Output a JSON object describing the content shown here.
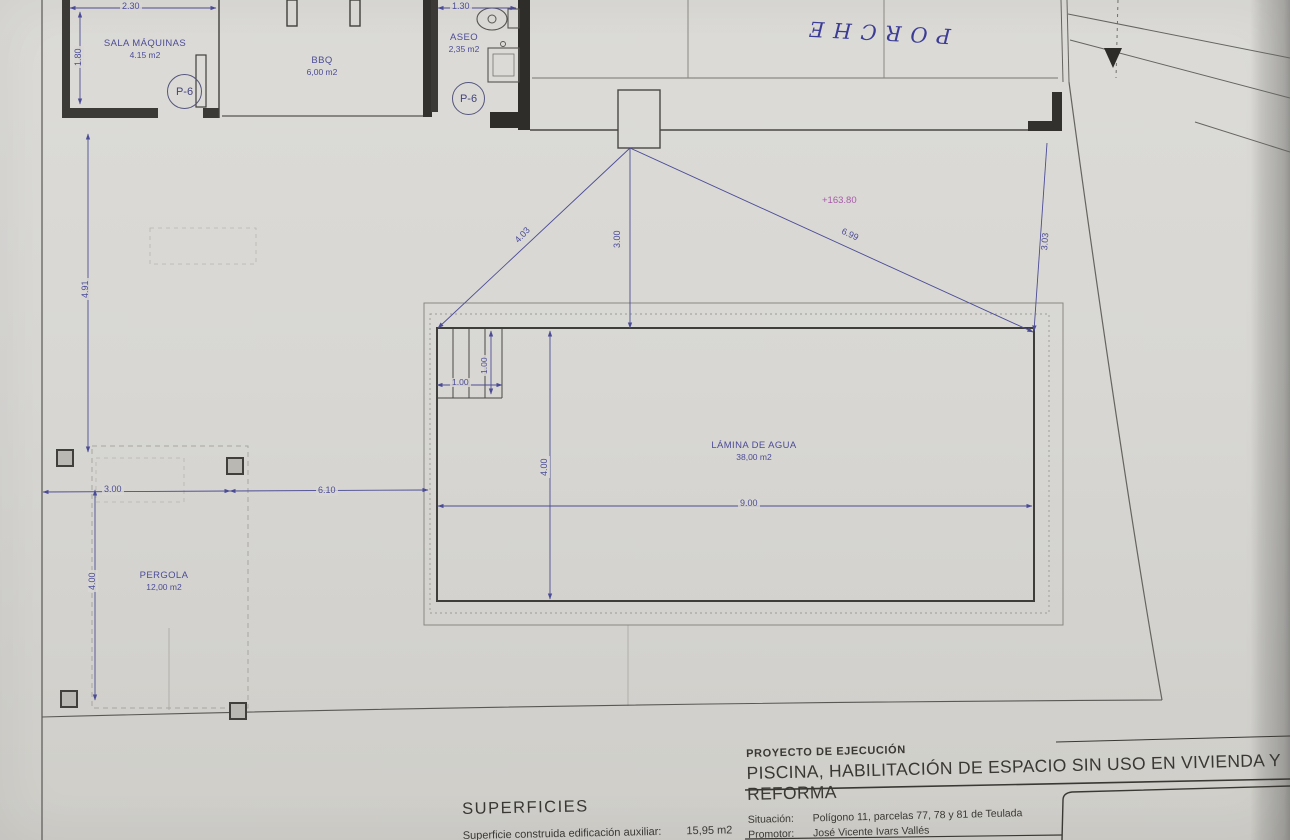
{
  "plan": {
    "rooms": {
      "sala_maquinas": {
        "name": "SALA MÁQUINAS",
        "area": "4.15 m2"
      },
      "bbq": {
        "name": "BBQ",
        "area": "6,00 m2"
      },
      "aseo": {
        "name": "ASEO",
        "area": "2,35 m2"
      },
      "porche": {
        "name": "PORCHE"
      },
      "pergola": {
        "name": "PERGOLA",
        "area": "12,00 m2"
      },
      "lamina_de_agua": {
        "name": "LÁMINA DE AGUA",
        "area": "38,00 m2"
      }
    },
    "doors": {
      "p6_sala": "P-6",
      "p6_aseo": "P-6"
    },
    "level_mark": "+163.80",
    "dims": {
      "sala_width": "2.30",
      "sala_height": "1.80",
      "aseo_width": "1.30",
      "left_upper": "4.91",
      "left_lower": "4.00",
      "ground_left": "3.00",
      "ground_right": "6.10",
      "steps_w": "1.00",
      "steps_h": "1.00",
      "pool_width": "4.00",
      "pool_length": "9.00",
      "diag_left": "4.03",
      "center_vert": "3.00",
      "diag_right": "6.99",
      "right_vert": "3.03"
    }
  },
  "title_block": {
    "project_type": "PROYECTO DE EJECUCIÓN",
    "project_title": "PISCINA, HABILITACIÓN DE ESPACIO SIN USO EN VIVIENDA Y REFORMA",
    "rows": [
      {
        "label": "Situación:",
        "value": "Polígono 11, parcelas 77, 78 y 81 de Teulada"
      },
      {
        "label": "Promotor:",
        "value": "José Vicente Ivars Vallés"
      },
      {
        "label": "Fecha:",
        "value": "Octubre de 2021"
      }
    ]
  },
  "superficies": {
    "heading": "SUPERFICIES",
    "row_label": "Superficie construida edificación auxiliar:",
    "row_value": "15,95 m2"
  },
  "colors": {
    "ink_blue": "#4c4c96",
    "line_dark": "#45433f",
    "level_magenta": "#a85aaa",
    "paper": "#d7d6d2"
  }
}
